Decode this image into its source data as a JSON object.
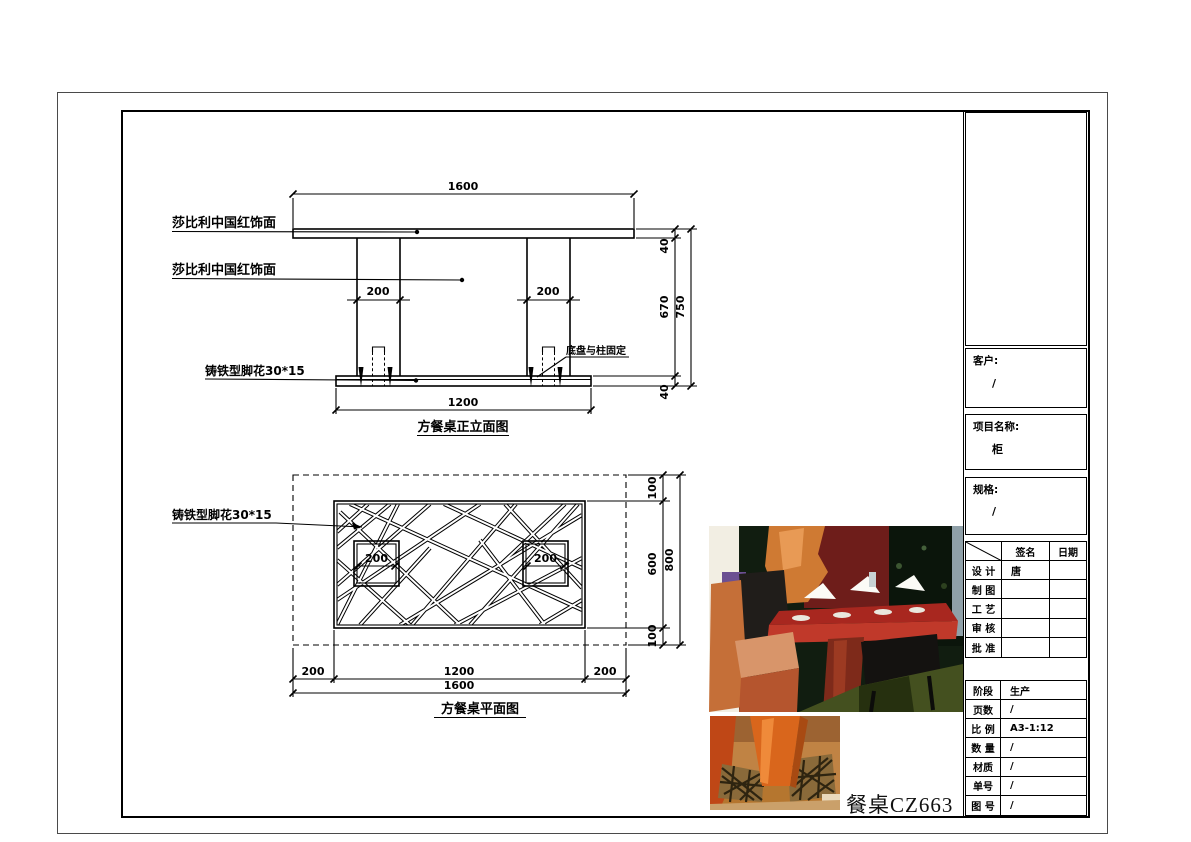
{
  "sheet": {
    "product_title": "餐桌CZ663"
  },
  "elevation": {
    "caption": "方餐桌正立面图",
    "label_top_finish": "莎比利中国红饰面",
    "label_column_finish": "莎比利中国红饰面",
    "label_foot": "铸铁型脚花30*15",
    "note_base_fix": "底盘与柱固定",
    "dim_total_width": "1600",
    "dim_col_left": "200",
    "dim_col_right": "200",
    "dim_top_thickness": "40",
    "dim_column_height": "670",
    "dim_total_height": "750",
    "dim_base_thickness": "40",
    "dim_base_width": "1200"
  },
  "plan": {
    "caption": "方餐桌平面图",
    "label_foot": "铸铁型脚花30*15",
    "dim_col_left": "200",
    "dim_col_right": "200",
    "dim_top_margin": "100",
    "dim_depth_inner": "600",
    "dim_total_depth": "800",
    "dim_bottom_margin": "100",
    "dim_left_margin": "200",
    "dim_inner_width": "1200",
    "dim_right_margin": "200",
    "dim_total_width": "1600"
  },
  "title_block": {
    "client_label": "客户:",
    "client_value": "/",
    "project_label": "项目名称:",
    "project_value": "柜",
    "spec_label": "规格:",
    "spec_value": "/",
    "sign_header_sign": "签名",
    "sign_header_date": "日期",
    "rows": [
      {
        "label": "设 计",
        "sign": "唐",
        "date": ""
      },
      {
        "label": "制 图",
        "sign": "",
        "date": ""
      },
      {
        "label": "工 艺",
        "sign": "",
        "date": ""
      },
      {
        "label": "审 核",
        "sign": "",
        "date": ""
      },
      {
        "label": "批 准",
        "sign": "",
        "date": ""
      }
    ],
    "info_rows": [
      {
        "label": "阶段",
        "value": "生产"
      },
      {
        "label": "页数",
        "value": "/"
      },
      {
        "label": "比 例",
        "value": "A3-1:12"
      },
      {
        "label": "数 量",
        "value": "/"
      },
      {
        "label": "材质",
        "value": "/"
      },
      {
        "label": "单号",
        "value": "/"
      },
      {
        "label": "图 号",
        "value": "/"
      }
    ]
  },
  "colors": {
    "line": "#000000",
    "table_red": "#a8271f",
    "chair_orange": "#c56f38",
    "column_orange": "#d9661c"
  }
}
